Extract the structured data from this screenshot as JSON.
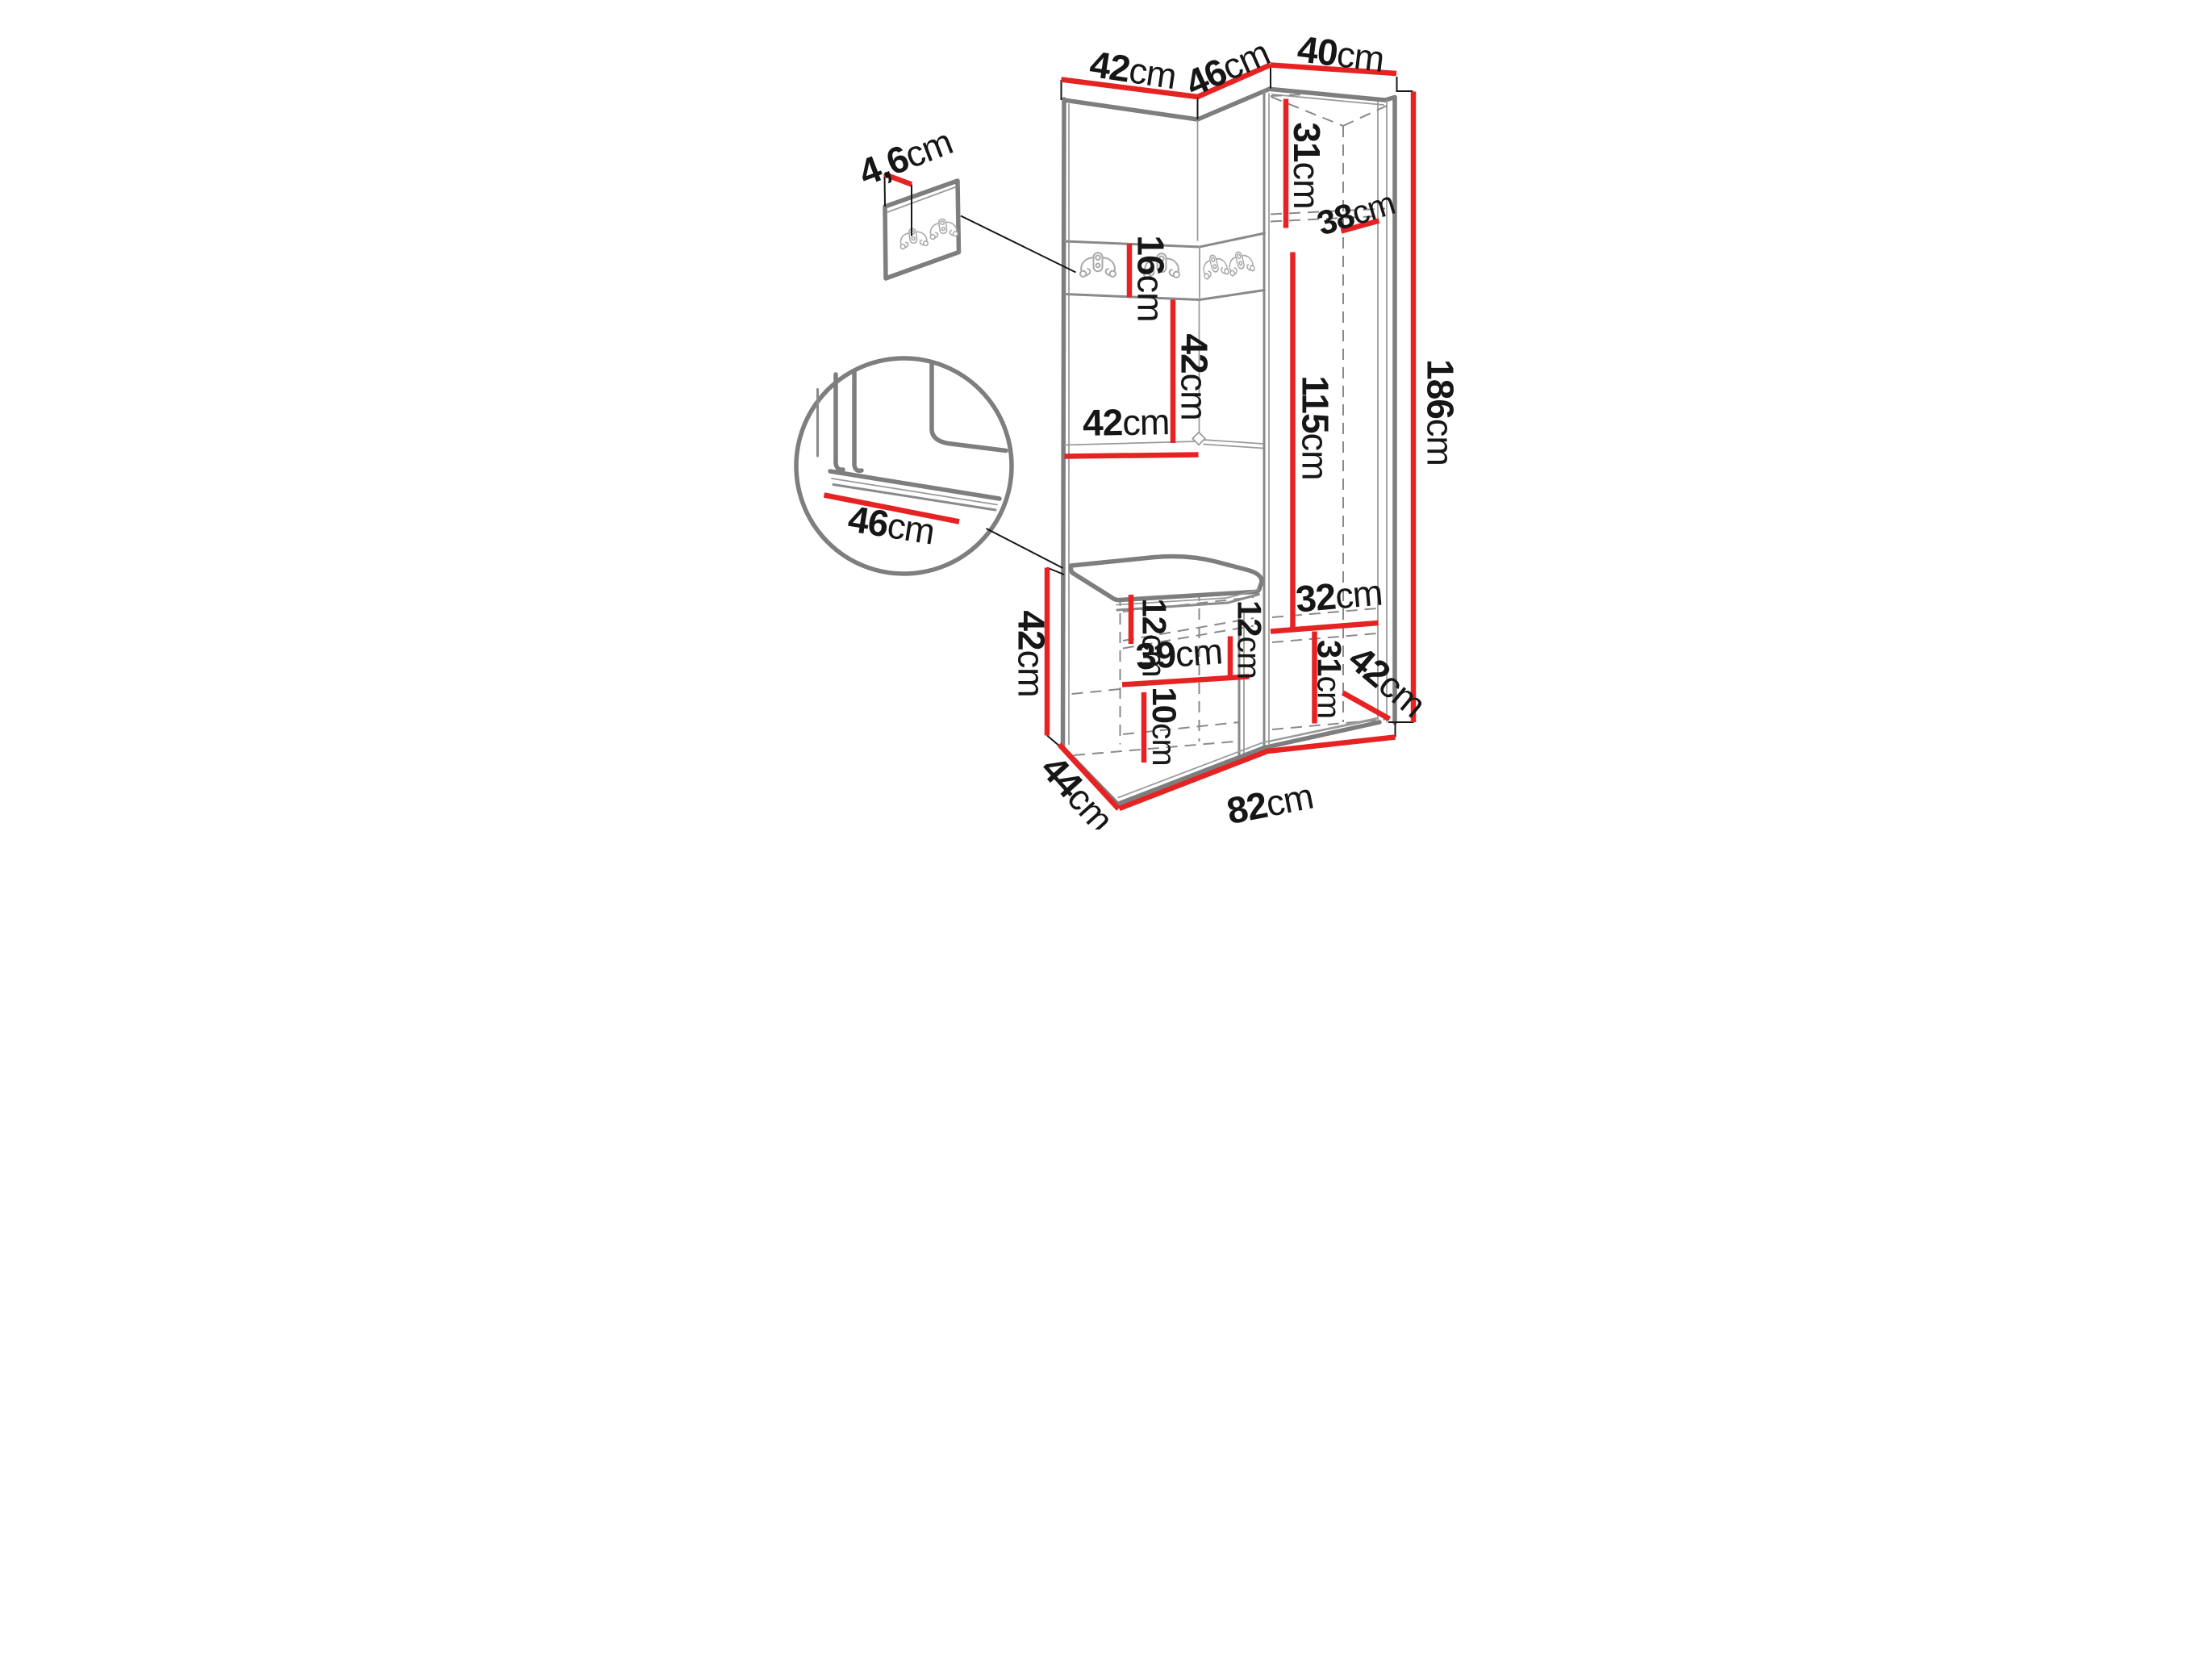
{
  "diagram": {
    "unit": "cm",
    "colors": {
      "dimension_line": "#e62222",
      "structure_line": "#7e7e7e",
      "label_text": "#161616"
    },
    "labels": {
      "top_width_left": {
        "value": "42",
        "unit": "cm"
      },
      "top_width_middle": {
        "value": "46",
        "unit": "cm"
      },
      "top_width_right": {
        "value": "40",
        "unit": "cm"
      },
      "hook_panel_offset": {
        "value": "4,6",
        "unit": "cm"
      },
      "hook_strip_height": {
        "value": "16",
        "unit": "cm"
      },
      "open_section_height": {
        "value": "42",
        "unit": "cm"
      },
      "shelf_width": {
        "value": "42",
        "unit": "cm"
      },
      "cabinet_top_compartment_height": {
        "value": "31",
        "unit": "cm"
      },
      "cabinet_inner_depth": {
        "value": "38",
        "unit": "cm"
      },
      "cabinet_inner_height": {
        "value": "115",
        "unit": "cm"
      },
      "total_height": {
        "value": "186",
        "unit": "cm"
      },
      "detail_seat_depth": {
        "value": "46",
        "unit": "cm"
      },
      "bench_height": {
        "value": "42",
        "unit": "cm"
      },
      "bench_top_gap": {
        "value": "12",
        "unit": "cm"
      },
      "bench_mid_gap": {
        "value": "12",
        "unit": "cm"
      },
      "bench_shelf_width": {
        "value": "39",
        "unit": "cm"
      },
      "bench_bottom_gap": {
        "value": "10",
        "unit": "cm"
      },
      "cabinet_shelf_width": {
        "value": "32",
        "unit": "cm"
      },
      "cabinet_bottom_compartment_height": {
        "value": "31",
        "unit": "cm"
      },
      "cabinet_depth": {
        "value": "42",
        "unit": "cm"
      },
      "bench_depth": {
        "value": "44",
        "unit": "cm"
      },
      "total_width": {
        "value": "82",
        "unit": "cm"
      }
    }
  }
}
